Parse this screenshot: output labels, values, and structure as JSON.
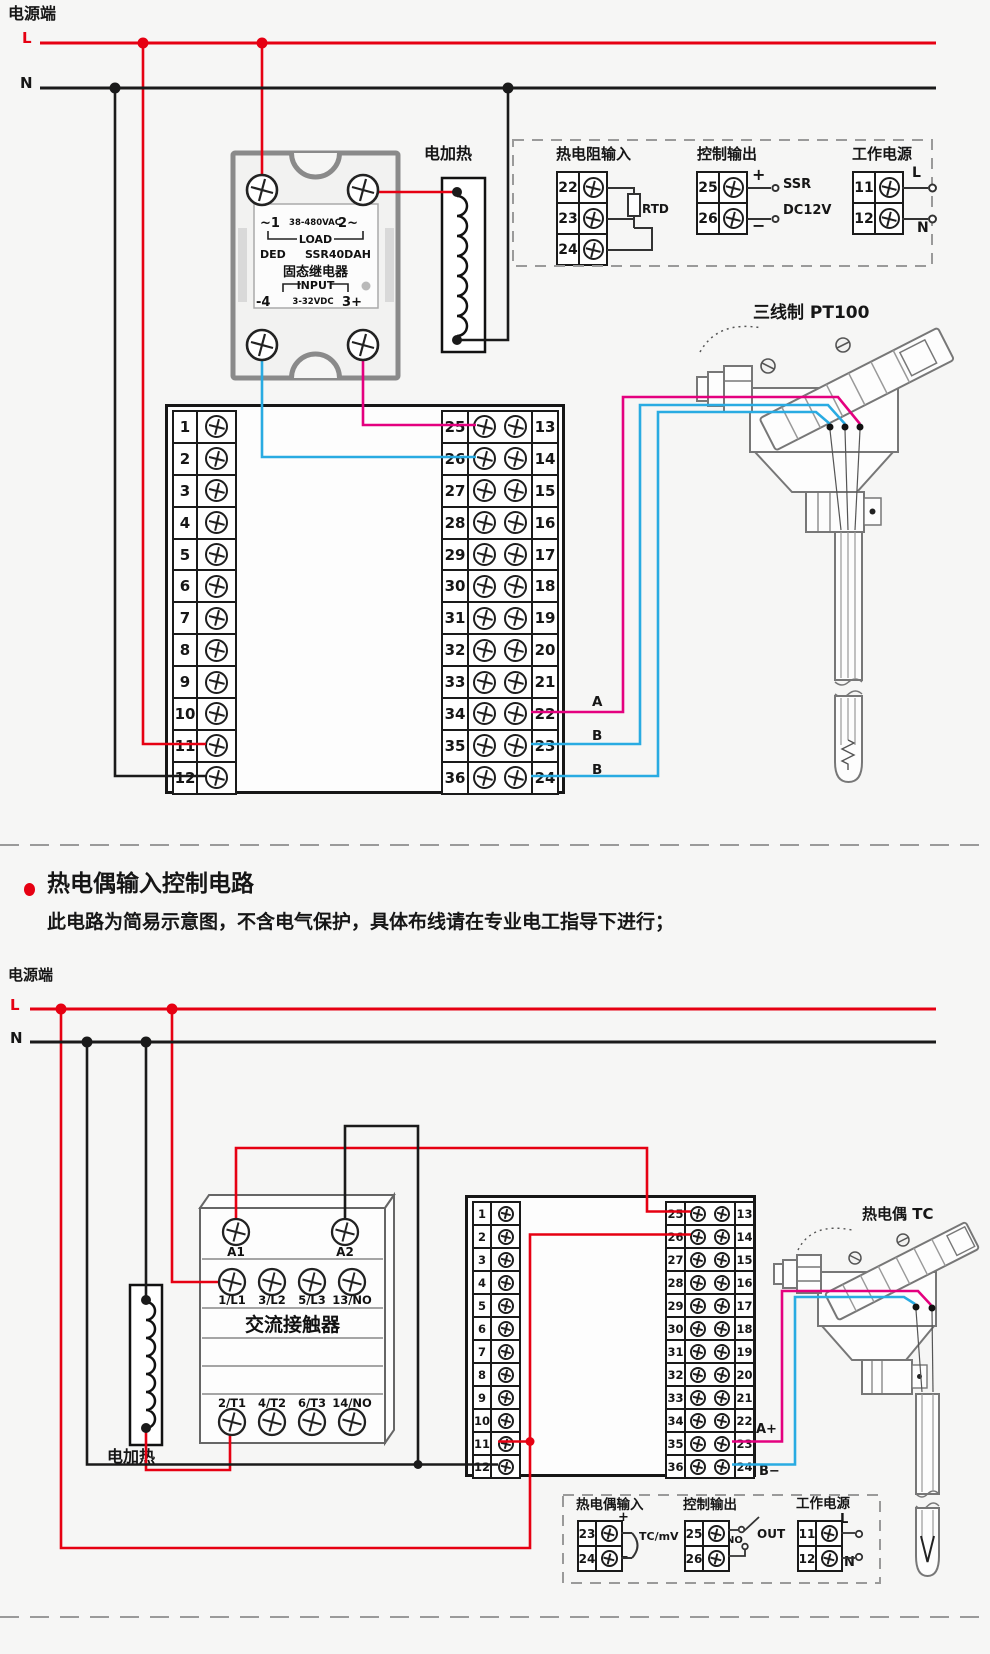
{
  "colors": {
    "wire_live": "#e60012",
    "wire_neutral": "#1a1a1a",
    "wire_signal_pink": "#e4007f",
    "wire_signal_blue": "#29abe2"
  },
  "rtd_circuit": {
    "power_label": "电源端",
    "l": "L",
    "n": "N",
    "heater": "电加热",
    "ssr": {
      "t1": "~1",
      "vac": "38-480VAC",
      "t2": "2~",
      "load": "LOAD",
      "brand": "DED",
      "model": "SSR40DAH",
      "name": "固态继电器",
      "input": "INPUT",
      "t4": "-4",
      "vdc": "3-32VDC",
      "t3": "3+"
    },
    "dc_plus": "+",
    "dc_label": "DC12V",
    "dc_minus": "−",
    "pid_line1": "PID控制输出",
    "pid_line2": "SSR驱动电压",
    "sensor_title": "三线制 PT100",
    "wire_a": "A",
    "wire_b1": "B",
    "wire_b2": "B",
    "block": {
      "left": [
        "1",
        "2",
        "3",
        "4",
        "5",
        "6",
        "7",
        "8",
        "9",
        "10",
        "11",
        "12"
      ],
      "mid": [
        "25",
        "26",
        "27",
        "28",
        "29",
        "30",
        "31",
        "32",
        "33",
        "34",
        "35",
        "36"
      ],
      "right": [
        "13",
        "14",
        "15",
        "16",
        "17",
        "18",
        "19",
        "20",
        "21",
        "22",
        "23",
        "24"
      ]
    },
    "info": {
      "rtd": {
        "title": "热电阻输入",
        "terminals": [
          "22",
          "23",
          "24"
        ],
        "label": "RTD"
      },
      "out": {
        "title": "控制输出",
        "terminals": [
          "25",
          "26"
        ],
        "plus": "+",
        "minus": "−",
        "line1": "SSR",
        "line2": "DC12V"
      },
      "pwr": {
        "title": "工作电源",
        "terminals": [
          "11",
          "12"
        ],
        "l": "L",
        "n": "N"
      }
    }
  },
  "tc_circuit": {
    "title": "热电偶输入控制电路",
    "subtitle": "此电路为简易示意图，不含电气保护，具体布线请在专业电工指导下进行；",
    "power_label": "电源端",
    "l": "L",
    "n": "N",
    "heater": "电加热",
    "contactor": {
      "a1": "A1",
      "a2": "A2",
      "row1": [
        "1/L1",
        "3/L2",
        "5/L3",
        "13/NO"
      ],
      "name": "交流接触器",
      "row2": [
        "2/T1",
        "4/T2",
        "6/T3",
        "14/NO"
      ]
    },
    "sensor_title": "热电偶 TC",
    "wire_a": "A+",
    "wire_b": "B−",
    "block": {
      "left": [
        "1",
        "2",
        "3",
        "4",
        "5",
        "6",
        "7",
        "8",
        "9",
        "10",
        "11",
        "12"
      ],
      "mid": [
        "25",
        "26",
        "27",
        "28",
        "29",
        "30",
        "31",
        "32",
        "33",
        "34",
        "35",
        "36"
      ],
      "right": [
        "13",
        "14",
        "15",
        "16",
        "17",
        "18",
        "19",
        "20",
        "21",
        "22",
        "23",
        "24"
      ]
    },
    "info": {
      "tc": {
        "title": "热电偶输入",
        "terminals": [
          "23",
          "24"
        ],
        "plus": "+",
        "minus": "−",
        "label": "TC/mV"
      },
      "out": {
        "title": "控制输出",
        "terminals": [
          "25",
          "26"
        ],
        "no": "NO",
        "out": "OUT"
      },
      "pwr": {
        "title": "工作电源",
        "terminals": [
          "11",
          "12"
        ],
        "l": "L",
        "n": "N"
      }
    }
  }
}
